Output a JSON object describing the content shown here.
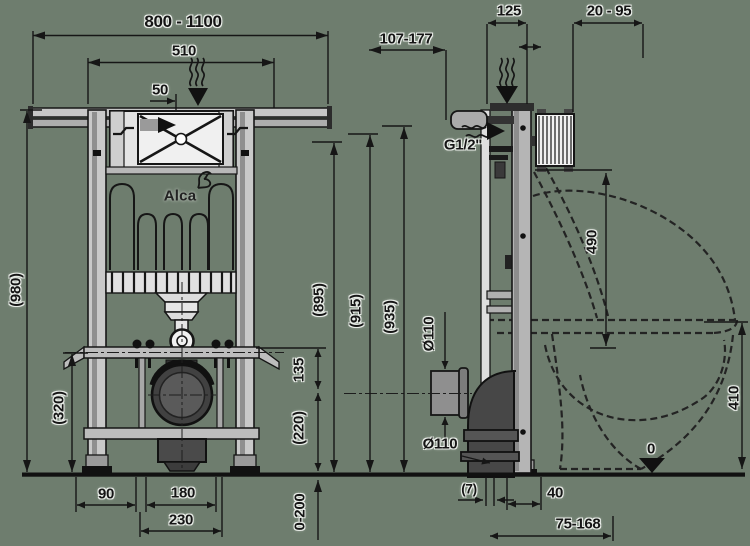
{
  "background": "#6e7d6e",
  "brand": {
    "logo": "Alca"
  },
  "front_view": {
    "dimensions": {
      "width_range": "800 - 1100",
      "inner_width": "510",
      "top_offset": "50",
      "total_height": "(980)",
      "lower_height": "(320)",
      "foot_offset": "90",
      "drain_width": "180",
      "drain_outer_width": "230",
      "mid_spacing": "135",
      "drain_height": "(220)",
      "ref_height_1": "(895)",
      "ref_height_2": "(915)",
      "ref_height_3": "(935)",
      "leg_adjust_range": "0-200"
    }
  },
  "side_view": {
    "dimensions": {
      "wall_distance_range": "107-177",
      "frame_depth": "125",
      "bracket_range": "20 - 95",
      "water_connection": "G1/2\"",
      "inlet_height": "490",
      "drain_diameter_top": "Ø110",
      "drain_diameter_bottom": "Ø110",
      "seat_height": "410",
      "floor_level": "0",
      "front_offset": "(7)",
      "outlet_offset": "40",
      "outlet_range": "75-168"
    }
  }
}
